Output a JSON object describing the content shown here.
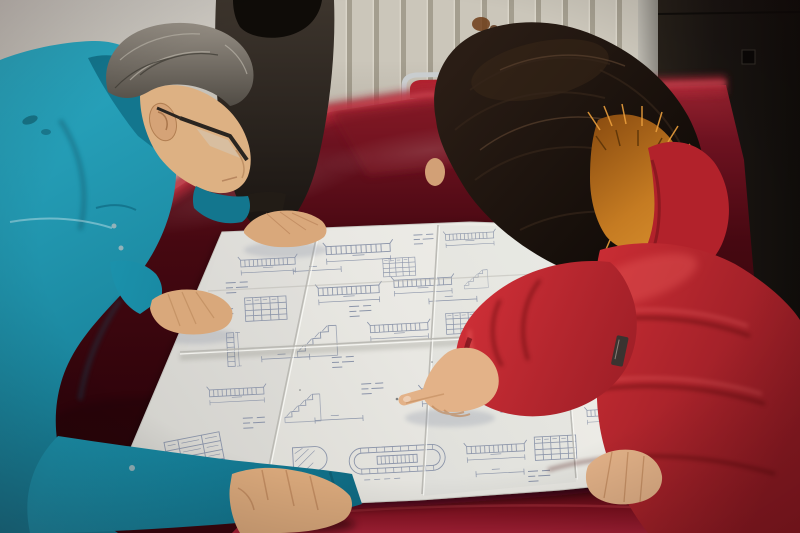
{
  "scene": {
    "alt": "Three people lean over a large folded engineering blueprint spread on a dark red velvet table: a gray-haired man in a teal work jacket and glasses studies the sheet, a colleague in a dark jacket rests a hand on it, and a woman in a red fur-trimmed parka points at a detail."
  },
  "entities": {
    "wall": {
      "label": "plaster wall"
    },
    "radiator": {
      "label": "wall radiator with vertical fins"
    },
    "stain": {
      "label": "rust stain on wall"
    },
    "door_frame": {
      "label": "light door frame edge"
    },
    "door": {
      "label": "dark door panel"
    },
    "chair": {
      "label": "metal framed chair with red cushion"
    },
    "table": {
      "label": "table draped in dark red velvet"
    },
    "blueprint": {
      "label": "folded engineering blueprint sheet"
    },
    "colleague": {
      "label": "colleague in dark jacket resting a hand on the drawing"
    },
    "man": {
      "label": "man in teal jacket with glasses studying the drawing"
    },
    "woman": {
      "label": "woman in red fur-trimmed parka pointing at the drawing"
    }
  },
  "palette": {
    "wall": "#c9c5bd",
    "radiator_fin": "#cbc6ba",
    "radiator_groove": "#a49e8f",
    "door": "#1c1713",
    "door_frame": "#b2afa6",
    "door_latch": "#0a0806",
    "chair_chrome": "#c9cdcf",
    "chair_cushion": "#b02330",
    "stain": "#6e3c18",
    "paper_edge": "#c9c8c2",
    "ink": "#7c87a0",
    "crease": "#b7b6b0",
    "speck": "#3a3f46",
    "jacket_teal": "#1d9ab5",
    "collar_teal": "#13768e",
    "snap_metal": "#9fb6ba",
    "colleague_coat": "#2e2822",
    "colleague_hair": "#0f0c08",
    "hair_gray": "#7e7870",
    "face_skin": "#ddb183",
    "hand_skin": "#d9a87b",
    "skin_shadow": "#b9835a",
    "glasses": "#2a2520",
    "ear_line": "#a9764c",
    "hair_dark": "#171008",
    "curl_dark": "#171008",
    "fur_orange": "#c57b22",
    "hood_red": "#b2222b",
    "coat_red": "#c32830",
    "woman_skin": "#e3b288",
    "woman_skin_line": "#c08a5e",
    "nail": "#edcdb2",
    "zipper": "#3a3330"
  }
}
